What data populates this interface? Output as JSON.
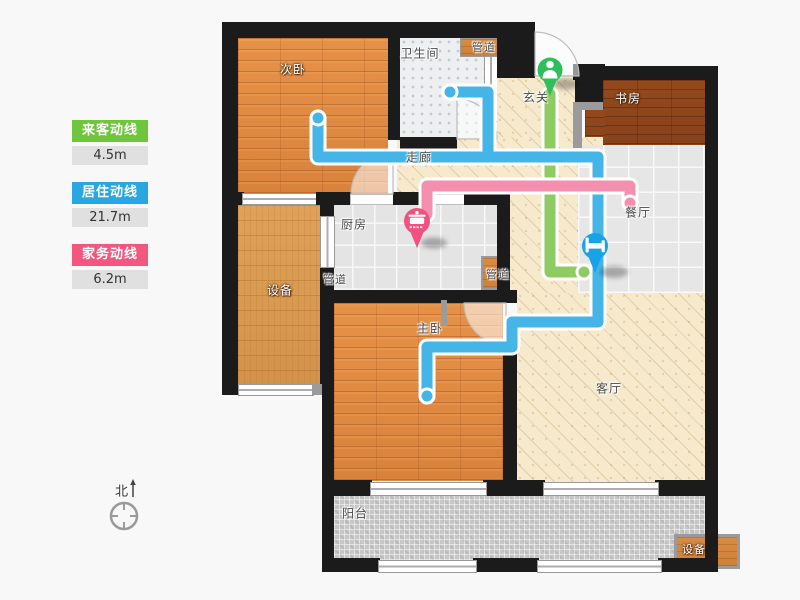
{
  "legend": {
    "items": [
      {
        "label": "来客动线",
        "value": "4.5m",
        "color": "#6FC63C"
      },
      {
        "label": "居住动线",
        "value": "21.7m",
        "color": "#29A7E2"
      },
      {
        "label": "家务动线",
        "value": "6.2m",
        "color": "#F2587F"
      }
    ]
  },
  "compass": {
    "north_label": "北"
  },
  "rooms": {
    "ciwo": "次卧",
    "weishengjian": "卫生间",
    "guandao": "管道",
    "xuanguan": "玄关",
    "shufang": "书房",
    "zoulang": "走廊",
    "canting": "餐厅",
    "chufang": "厨房",
    "shebei": "设备",
    "zhuwo": "主卧",
    "keting": "客厅",
    "yangtai": "阳台"
  },
  "paths": {
    "visitor": {
      "name": "来客动线",
      "color": "#8FCB63"
    },
    "resident": {
      "name": "居住动线",
      "color": "#45B5E8"
    },
    "housework": {
      "name": "家务动线",
      "color": "#F48FB0"
    }
  },
  "pins": {
    "entrance": {
      "icon": "person-icon",
      "color": "#2EBE5A"
    },
    "kitchen": {
      "icon": "pot-icon",
      "color": "#F0517E"
    },
    "bedroom": {
      "icon": "bed-icon",
      "color": "#17A3E8"
    }
  }
}
